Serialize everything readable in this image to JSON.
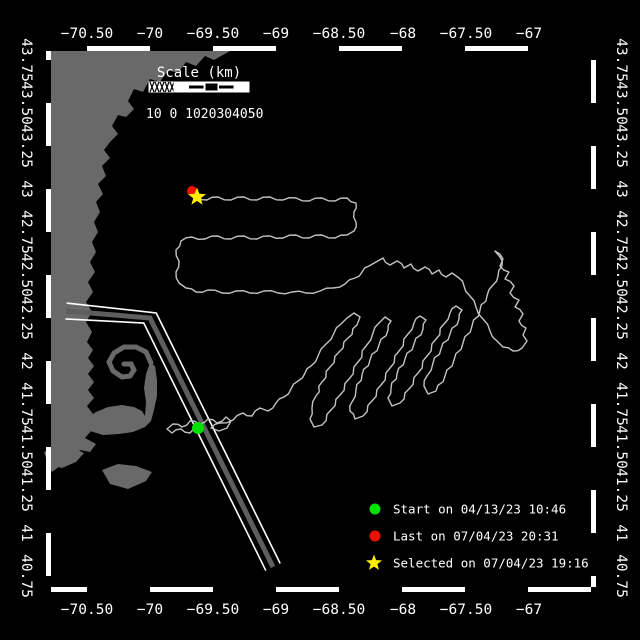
{
  "colors": {
    "background": "#000000",
    "land": "#696969",
    "track": "#c3c3c3",
    "frame": "#ffffff",
    "lane_stripe": "#5e5e5e",
    "text": "#ffffff",
    "start": "#00e100",
    "last": "#ee1100",
    "selected": "#ffee00"
  },
  "axes": {
    "lon_ticks": [
      {
        "label": "−70.50",
        "x": 87
      },
      {
        "label": "−70",
        "x": 150
      },
      {
        "label": "−69.50",
        "x": 213
      },
      {
        "label": "−69",
        "x": 276
      },
      {
        "label": "−68.50",
        "x": 339
      },
      {
        "label": "−68",
        "x": 403
      },
      {
        "label": "−67.50",
        "x": 466
      },
      {
        "label": "−67",
        "x": 529
      }
    ],
    "lat_ticks": [
      {
        "label": "43.75",
        "y": 60
      },
      {
        "label": "43.50",
        "y": 103
      },
      {
        "label": "43.25",
        "y": 146
      },
      {
        "label": "43",
        "y": 189
      },
      {
        "label": "42.75",
        "y": 232
      },
      {
        "label": "42.50",
        "y": 275
      },
      {
        "label": "42.25",
        "y": 318
      },
      {
        "label": "42",
        "y": 361
      },
      {
        "label": "41.75",
        "y": 404
      },
      {
        "label": "41.50",
        "y": 447
      },
      {
        "label": "41.25",
        "y": 490
      },
      {
        "label": "41",
        "y": 533
      },
      {
        "label": "40.75",
        "y": 576
      }
    ]
  },
  "scalebar": {
    "title": "Scale (km)",
    "tick_labels": "10 0 1020304050",
    "x": 149,
    "y": 82,
    "height": 10,
    "segment_styles": [
      "hatch",
      "solid",
      "midline",
      "outline",
      "midline",
      "solid"
    ],
    "hatch_width": 25,
    "segment_width": 15
  },
  "legend": {
    "items": [
      {
        "marker": "circle",
        "color_key": "start",
        "label": "Start on 04/13/23 10:46"
      },
      {
        "marker": "circle",
        "color_key": "last",
        "label": "Last on 07/04/23 20:31"
      },
      {
        "marker": "star",
        "color_key": "selected",
        "label": "Selected on 07/04/23 19:16"
      }
    ],
    "marker_x": 375,
    "text_x": 393,
    "row_y": [
      509,
      536,
      563
    ]
  },
  "markers": {
    "start": {
      "x": 198,
      "y": 428
    },
    "last": {
      "x": 192,
      "y": 191
    },
    "selected": {
      "x": 197,
      "y": 197
    }
  },
  "frame": {
    "inner": {
      "x1": 51,
      "y1": 51,
      "x2": 591,
      "y2": 587
    },
    "band": 5,
    "lon_origin": 87,
    "lon_step": 63,
    "lat_origin": 60,
    "lat_step": 43
  },
  "geometry": {
    "coast_mainland": [
      [
        51,
        51
      ],
      [
        230,
        51
      ],
      [
        214,
        60
      ],
      [
        205,
        56
      ],
      [
        196,
        66
      ],
      [
        186,
        62
      ],
      [
        178,
        73
      ],
      [
        168,
        70
      ],
      [
        160,
        82
      ],
      [
        150,
        79
      ],
      [
        143,
        92
      ],
      [
        134,
        89
      ],
      [
        128,
        101
      ],
      [
        134,
        109
      ],
      [
        126,
        117
      ],
      [
        118,
        115
      ],
      [
        112,
        126
      ],
      [
        118,
        134
      ],
      [
        110,
        142
      ],
      [
        104,
        150
      ],
      [
        110,
        158
      ],
      [
        102,
        166
      ],
      [
        106,
        176
      ],
      [
        98,
        184
      ],
      [
        103,
        194
      ],
      [
        96,
        202
      ],
      [
        100,
        212
      ],
      [
        94,
        222
      ],
      [
        98,
        232
      ],
      [
        92,
        242
      ],
      [
        96,
        252
      ],
      [
        90,
        262
      ],
      [
        95,
        272
      ],
      [
        88,
        282
      ],
      [
        93,
        292
      ],
      [
        86,
        302
      ],
      [
        92,
        312
      ],
      [
        86,
        322
      ],
      [
        92,
        332
      ],
      [
        87,
        342
      ],
      [
        93,
        350
      ],
      [
        88,
        358
      ],
      [
        94,
        366
      ],
      [
        88,
        374
      ],
      [
        94,
        382
      ],
      [
        88,
        390
      ],
      [
        94,
        398
      ],
      [
        87,
        406
      ],
      [
        93,
        414
      ],
      [
        86,
        422
      ],
      [
        92,
        430
      ],
      [
        85,
        438
      ],
      [
        96,
        444
      ],
      [
        90,
        452
      ],
      [
        80,
        450
      ],
      [
        72,
        457
      ],
      [
        62,
        452
      ],
      [
        55,
        459
      ],
      [
        60,
        466
      ],
      [
        52,
        472
      ],
      [
        51,
        470
      ]
    ],
    "coast_cape": [
      [
        84,
        420
      ],
      [
        96,
        412
      ],
      [
        108,
        407
      ],
      [
        122,
        405
      ],
      [
        134,
        407
      ],
      [
        142,
        411
      ],
      [
        145,
        416
      ],
      [
        146,
        402
      ],
      [
        144,
        388
      ],
      [
        146,
        374
      ],
      [
        150,
        363
      ],
      [
        155,
        366
      ],
      [
        157,
        380
      ],
      [
        157,
        396
      ],
      [
        154,
        410
      ],
      [
        151,
        421
      ],
      [
        145,
        427
      ],
      [
        133,
        432
      ],
      [
        119,
        434
      ],
      [
        103,
        435
      ],
      [
        90,
        431
      ],
      [
        80,
        427
      ]
    ],
    "cape_hook": [
      [
        151,
        363
      ],
      [
        146,
        352
      ],
      [
        136,
        347
      ],
      [
        124,
        347
      ],
      [
        114,
        353
      ],
      [
        109,
        362
      ],
      [
        113,
        371
      ],
      [
        122,
        377
      ],
      [
        130,
        376
      ],
      [
        134,
        370
      ],
      [
        131,
        364
      ],
      [
        124,
        364
      ]
    ],
    "island_marthas_vineyard": [
      [
        44,
        452
      ],
      [
        58,
        446
      ],
      [
        72,
        447
      ],
      [
        84,
        453
      ],
      [
        76,
        462
      ],
      [
        62,
        468
      ],
      [
        48,
        464
      ]
    ],
    "island_nantucket": [
      [
        102,
        470
      ],
      [
        118,
        464
      ],
      [
        136,
        466
      ],
      [
        152,
        472
      ],
      [
        146,
        481
      ],
      [
        128,
        489
      ],
      [
        110,
        484
      ]
    ],
    "shipping_lane": [
      [
        66,
        311
      ],
      [
        150,
        318
      ],
      [
        273,
        567
      ]
    ],
    "lane_half_width": 8,
    "track": [
      [
        198,
        428
      ],
      [
        190,
        433
      ],
      [
        181,
        429
      ],
      [
        172,
        433
      ],
      [
        167,
        429
      ],
      [
        173,
        424
      ],
      [
        182,
        427
      ],
      [
        190,
        421
      ],
      [
        199,
        424
      ],
      [
        208,
        419
      ],
      [
        217,
        423
      ],
      [
        226,
        417
      ],
      [
        231,
        421
      ],
      [
        227,
        428
      ],
      [
        219,
        431
      ],
      [
        211,
        428
      ],
      [
        220,
        423
      ],
      [
        233,
        420
      ],
      [
        243,
        413
      ],
      [
        252,
        416
      ],
      [
        260,
        408
      ],
      [
        268,
        411
      ],
      [
        276,
        403
      ],
      [
        284,
        397
      ],
      [
        291,
        389
      ],
      [
        298,
        381
      ],
      [
        305,
        373
      ],
      [
        311,
        366
      ],
      [
        318,
        356
      ],
      [
        326,
        344
      ],
      [
        334,
        333
      ],
      [
        341,
        324
      ],
      [
        347,
        318
      ],
      [
        354,
        313
      ],
      [
        360,
        317
      ],
      [
        357,
        325
      ],
      [
        348,
        338
      ],
      [
        339,
        352
      ],
      [
        330,
        367
      ],
      [
        322,
        382
      ],
      [
        316,
        396
      ],
      [
        312,
        408
      ],
      [
        310,
        419
      ],
      [
        314,
        427
      ],
      [
        322,
        425
      ],
      [
        331,
        410
      ],
      [
        340,
        395
      ],
      [
        349,
        379
      ],
      [
        358,
        362
      ],
      [
        366,
        346
      ],
      [
        373,
        333
      ],
      [
        379,
        323
      ],
      [
        385,
        317
      ],
      [
        391,
        321
      ],
      [
        388,
        330
      ],
      [
        379,
        345
      ],
      [
        370,
        360
      ],
      [
        362,
        375
      ],
      [
        356,
        390
      ],
      [
        352,
        402
      ],
      [
        350,
        411
      ],
      [
        355,
        419
      ],
      [
        363,
        416
      ],
      [
        372,
        401
      ],
      [
        381,
        385
      ],
      [
        390,
        368
      ],
      [
        399,
        351
      ],
      [
        408,
        334
      ],
      [
        414,
        323
      ],
      [
        420,
        316
      ],
      [
        426,
        320
      ],
      [
        423,
        329
      ],
      [
        414,
        344
      ],
      [
        405,
        359
      ],
      [
        397,
        374
      ],
      [
        391,
        388
      ],
      [
        388,
        398
      ],
      [
        392,
        406
      ],
      [
        400,
        403
      ],
      [
        409,
        389
      ],
      [
        418,
        373
      ],
      [
        427,
        356
      ],
      [
        436,
        339
      ],
      [
        444,
        324
      ],
      [
        450,
        313
      ],
      [
        456,
        306
      ],
      [
        462,
        310
      ],
      [
        459,
        319
      ],
      [
        450,
        334
      ],
      [
        441,
        349
      ],
      [
        433,
        363
      ],
      [
        427,
        376
      ],
      [
        424,
        386
      ],
      [
        428,
        394
      ],
      [
        436,
        391
      ],
      [
        445,
        376
      ],
      [
        454,
        360
      ],
      [
        463,
        343
      ],
      [
        472,
        326
      ],
      [
        480,
        310
      ],
      [
        487,
        296
      ],
      [
        493,
        285
      ],
      [
        498,
        276
      ],
      [
        502,
        266
      ],
      [
        500,
        257
      ],
      [
        495,
        251
      ],
      [
        503,
        259
      ],
      [
        500,
        266
      ],
      [
        509,
        272
      ],
      [
        505,
        279
      ],
      [
        514,
        286
      ],
      [
        510,
        293
      ],
      [
        519,
        300
      ],
      [
        515,
        307
      ],
      [
        523,
        314
      ],
      [
        519,
        321
      ],
      [
        526,
        328
      ],
      [
        523,
        335
      ],
      [
        527,
        341
      ],
      [
        522,
        348
      ],
      [
        513,
        351
      ],
      [
        503,
        347
      ],
      [
        497,
        341
      ],
      [
        490,
        331
      ],
      [
        483,
        319
      ],
      [
        476,
        307
      ],
      [
        470,
        296
      ],
      [
        464,
        286
      ],
      [
        459,
        278
      ],
      [
        452,
        273
      ],
      [
        446,
        277
      ],
      [
        439,
        270
      ],
      [
        432,
        274
      ],
      [
        425,
        267
      ],
      [
        418,
        271
      ],
      [
        411,
        264
      ],
      [
        404,
        268
      ],
      [
        397,
        261
      ],
      [
        390,
        265
      ],
      [
        383,
        258
      ],
      [
        376,
        262
      ],
      [
        369,
        266
      ],
      [
        362,
        272
      ],
      [
        355,
        278
      ],
      [
        345,
        284
      ],
      [
        333,
        288
      ],
      [
        320,
        291
      ],
      [
        306,
        293
      ],
      [
        292,
        292
      ],
      [
        278,
        293
      ],
      [
        264,
        291
      ],
      [
        250,
        293
      ],
      [
        236,
        291
      ],
      [
        222,
        293
      ],
      [
        208,
        290
      ],
      [
        196,
        292
      ],
      [
        186,
        288
      ],
      [
        179,
        283
      ],
      [
        176,
        272
      ],
      [
        179,
        261
      ],
      [
        176,
        250
      ],
      [
        181,
        241
      ],
      [
        192,
        237
      ],
      [
        205,
        239
      ],
      [
        218,
        236
      ],
      [
        231,
        239
      ],
      [
        244,
        236
      ],
      [
        257,
        239
      ],
      [
        270,
        236
      ],
      [
        283,
        238
      ],
      [
        296,
        235
      ],
      [
        309,
        238
      ],
      [
        322,
        235
      ],
      [
        335,
        238
      ],
      [
        347,
        235
      ],
      [
        354,
        231
      ],
      [
        356,
        222
      ],
      [
        354,
        212
      ],
      [
        356,
        203
      ],
      [
        347,
        198
      ],
      [
        335,
        201
      ],
      [
        322,
        198
      ],
      [
        309,
        201
      ],
      [
        296,
        198
      ],
      [
        283,
        200
      ],
      [
        270,
        197
      ],
      [
        257,
        200
      ],
      [
        244,
        197
      ],
      [
        231,
        200
      ],
      [
        218,
        197
      ],
      [
        207,
        200
      ],
      [
        198,
        197
      ]
    ]
  }
}
